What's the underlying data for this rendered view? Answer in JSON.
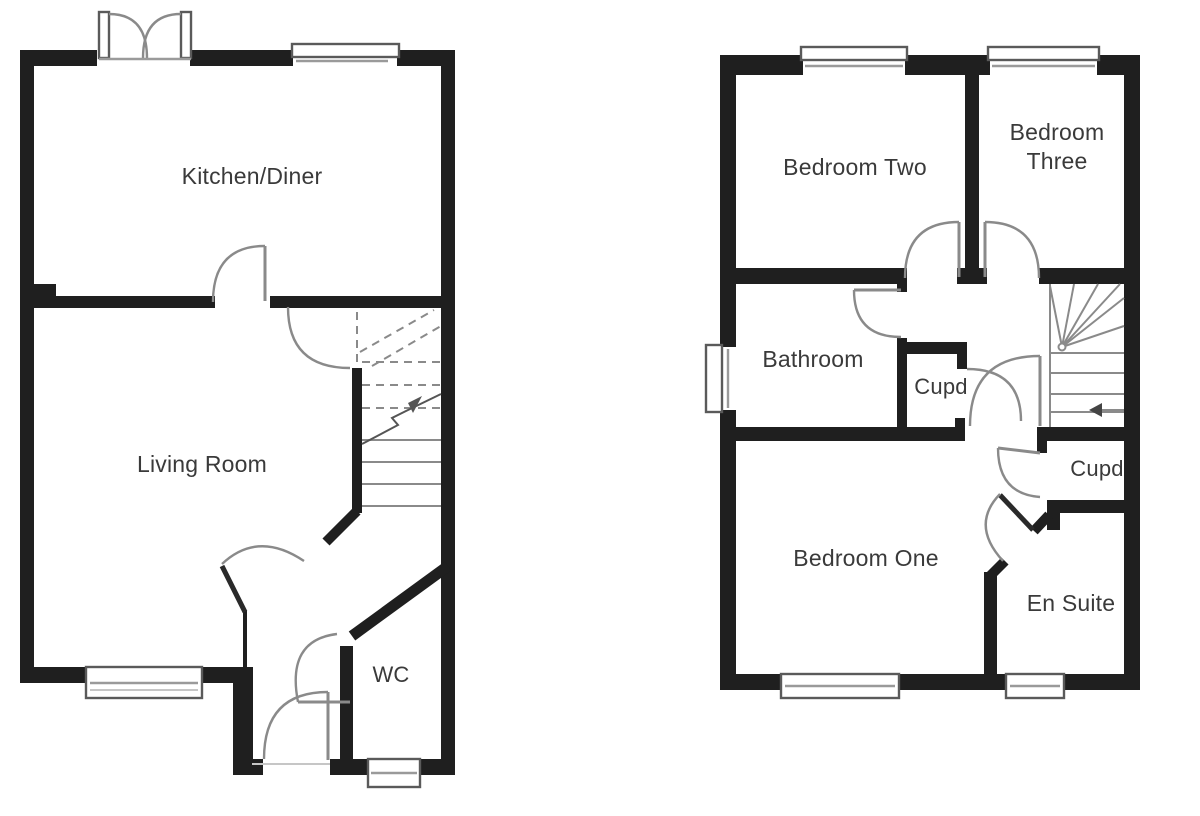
{
  "colors": {
    "background": "#ffffff",
    "wall": "#1f1f1f",
    "door_arc": "#8a8a8a",
    "window_frame": "#5a5a5a",
    "label_text": "#3a3a3a"
  },
  "ground_floor": {
    "kitchen_diner": "Kitchen/Diner",
    "living_room": "Living Room",
    "wc": "WC"
  },
  "first_floor": {
    "bedroom_two": "Bedroom Two",
    "bedroom_three_line1": "Bedroom",
    "bedroom_three_line2": "Three",
    "bathroom": "Bathroom",
    "cupboard_landing": "Cupd",
    "cupboard_stairs": "Cupd",
    "bedroom_one": "Bedroom One",
    "en_suite": "En Suite"
  }
}
